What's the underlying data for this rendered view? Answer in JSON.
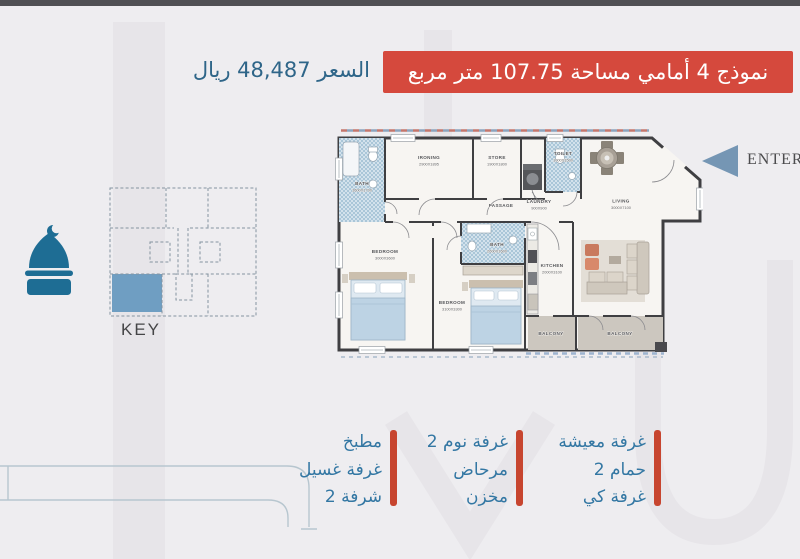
{
  "header": {
    "title": "نموذج 4 أمامي مساحة 107.75 متر مربع",
    "price": "السعر 48,487 ريال"
  },
  "plan": {
    "enter_label": "ENTER",
    "rooms": [
      {
        "name": "BATH",
        "dims": "1600X1700"
      },
      {
        "name": "IRONING",
        "dims": "2900X1895"
      },
      {
        "name": "STORE",
        "dims": "1900X1800"
      },
      {
        "name": "LAUNDRY",
        "dims": "900X900"
      },
      {
        "name": "TOILET",
        "dims": "1000X1500"
      },
      {
        "name": "PASSAGE",
        "dims": ""
      },
      {
        "name": "LIVING",
        "dims": "3000X7100"
      },
      {
        "name": "BEDROOM",
        "dims": "3000X3600"
      },
      {
        "name": "BEDROOM",
        "dims": "3100X3300"
      },
      {
        "name": "BATH",
        "dims": "2600X1600"
      },
      {
        "name": "KITCHEN",
        "dims": "2000X3100"
      },
      {
        "name": "BALCONY",
        "dims": ""
      },
      {
        "name": "BALCONY",
        "dims": ""
      }
    ]
  },
  "key_map": {
    "label": "KEY"
  },
  "features": {
    "col_right": [
      "غرفة معيشة",
      "2 حمام",
      "غرفة كي"
    ],
    "col_middle": [
      "2 غرفة نوم",
      "مرحاض",
      "مخزن"
    ],
    "col_left": [
      "مطبخ",
      "غرفة غسيل",
      "2 شرفة"
    ]
  },
  "icons": {
    "brand": "mosque-dome-icon",
    "entrance": "left-triangle-arrow-icon"
  },
  "colors": {
    "accent_red": "#d5493d",
    "price_blue": "#2e6588",
    "feature_blue": "#3377a3",
    "bar_red": "#c7452f",
    "arrow_blue": "#7596b4",
    "mosque_teal": "#1e6d94",
    "key_highlight_blue": "#6f9ec2",
    "topbar_gray": "#505054",
    "background": "#eeedf0"
  }
}
